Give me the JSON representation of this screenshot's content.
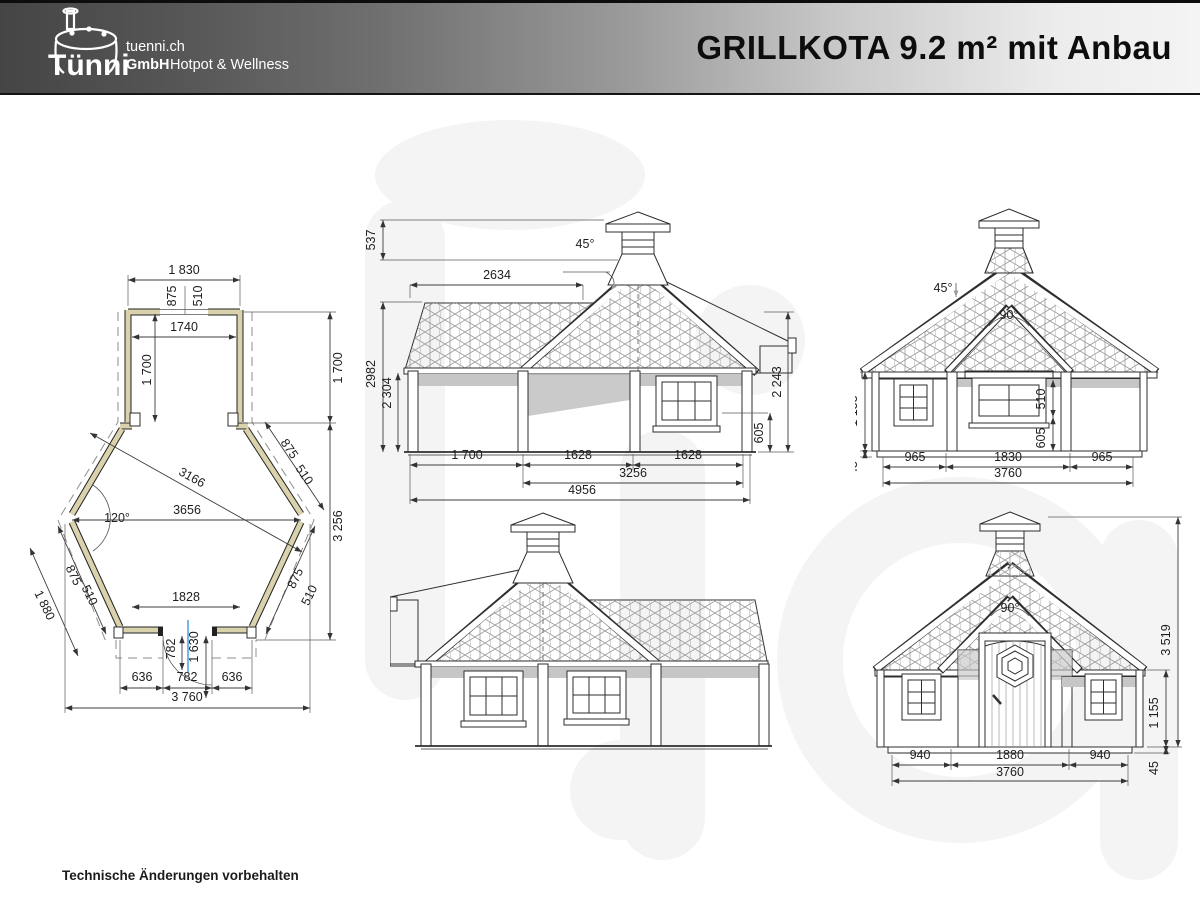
{
  "header": {
    "logo": {
      "brand": "Tünni",
      "site": "tuenni.ch",
      "company": "GmbH",
      "tagline": "Hotpot & Wellness"
    },
    "title": "GRILLKOTA 9.2 m² mit Anbau"
  },
  "footer": {
    "note": "Technische Änderungen vorbehalten"
  },
  "views": {
    "plan": {
      "dims": [
        "1 830",
        "875",
        "510",
        "1740",
        "1 700",
        "1 700",
        "3166",
        "120°",
        "3656",
        "875",
        "510",
        "875",
        "510",
        "875",
        "510",
        "1 880",
        "3 256",
        "1828",
        "782",
        "1 630",
        "636",
        "782",
        "636",
        "3 760"
      ]
    },
    "side_a": {
      "dims": [
        "537",
        "2634",
        "45°",
        "2982",
        "2 304",
        "2 243",
        "605",
        "1 700",
        "1628",
        "1628",
        "3256",
        "4956"
      ]
    },
    "rear": {
      "dims": [
        "45°",
        "90°",
        "1 155",
        "45",
        "510",
        "605",
        "965",
        "1830",
        "965",
        "3760"
      ]
    },
    "front": {
      "dims": [
        "90°",
        "3 519",
        "1 155",
        "45",
        "940",
        "1880",
        "940",
        "3760"
      ]
    }
  }
}
